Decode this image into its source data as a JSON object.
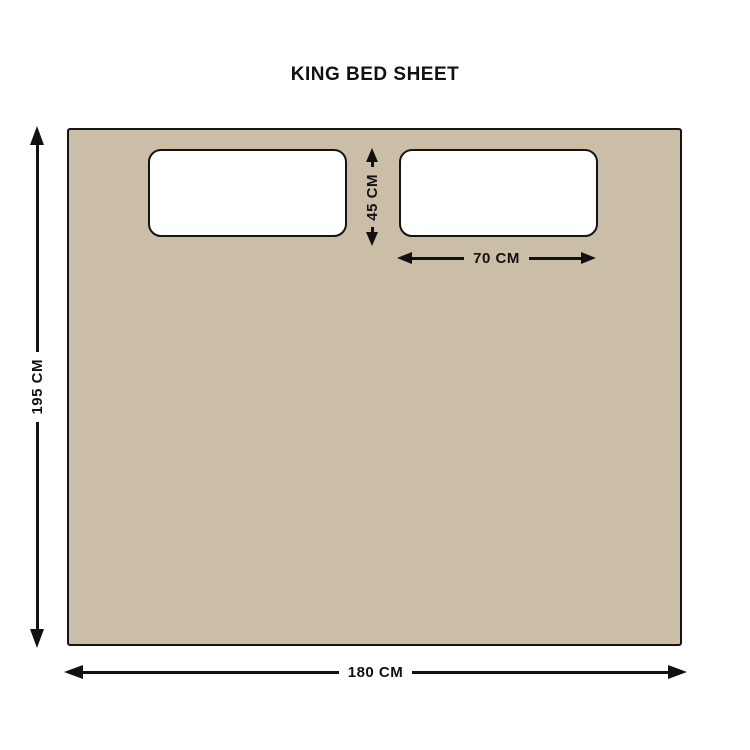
{
  "title": "KING BED SHEET",
  "dimensions": {
    "sheet_height": {
      "label": "195 CM"
    },
    "sheet_width": {
      "label": "180 CM"
    },
    "pillow_height": {
      "label": "45 CM"
    },
    "pillow_width": {
      "label": "70 CM"
    }
  },
  "colors": {
    "sheet_fill": "#CABEA7",
    "pillow_fill": "#FFFFFF",
    "outline": "#151515",
    "arrow": "#111111",
    "bg": "#FFFFFF",
    "text": "#111111"
  }
}
